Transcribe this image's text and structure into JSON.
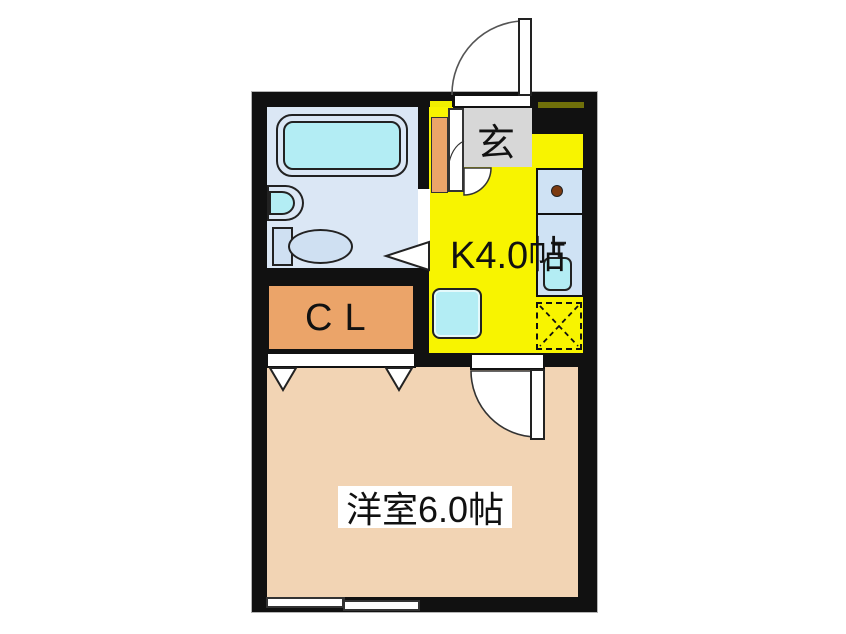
{
  "title": "1K apartment floor plan",
  "rooms": {
    "entrance": {
      "label": "玄"
    },
    "kitchen": {
      "label": "K4.0帖"
    },
    "closet": {
      "label": "CL"
    },
    "western_room": {
      "label": "洋室6.0帖"
    }
  },
  "fixtures": {
    "bathtub": "bathtub-icon",
    "wash_basin": "wash-basin-icon",
    "toilet": "toilet-icon",
    "stove_burner": "stove-burner-icon",
    "kitchen_sink": "kitchen-sink-icon",
    "refrigerator_space": "refrigerator-space-dashed-box",
    "washing_machine_space": "washing-machine-box",
    "shoe_cabinet": "shoe-cabinet-strip",
    "entrance_door": "swing-door-arc",
    "room_door": "swing-door-arc",
    "bathroom_door": "folding-door-triangle",
    "closet_doors": "folding-door-triangles",
    "window": "sliding-window"
  },
  "colors": {
    "wall": "#111111",
    "kitchen": "#f8f400",
    "room": "#f2d4b4",
    "bath": "#dbe7f5",
    "fixture": "#cfe0f2",
    "cyan": "#b3edf4",
    "counter": "#cfe2f4",
    "orange": "#eba469",
    "gray": "#d7d7d7",
    "dash_yellow": "#f0ef00",
    "dash_olive": "#70700a",
    "burner": "#7c3a10"
  }
}
